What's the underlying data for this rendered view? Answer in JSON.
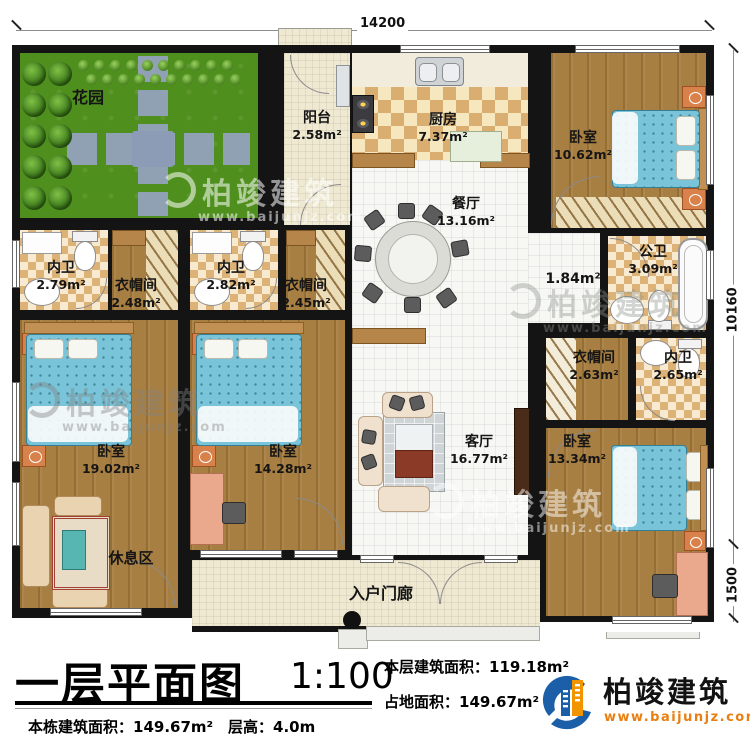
{
  "plan": {
    "title": "一层平面图",
    "scale": "1:100"
  },
  "dimensions": {
    "top": "14200",
    "right_main": "10160",
    "right_lower": "1500"
  },
  "rooms": {
    "garden": {
      "name": "花园"
    },
    "balcony": {
      "name": "阳台",
      "area": "2.58m²"
    },
    "kitchen": {
      "name": "厨房",
      "area": "7.37m²"
    },
    "dining": {
      "name": "餐厅",
      "area": "13.16m²"
    },
    "bedroom_top_right": {
      "name": "卧室",
      "area": "10.62m²"
    },
    "bath_1": {
      "name": "内卫",
      "area": "2.79m²"
    },
    "closet_1": {
      "name": "衣帽间",
      "area": "2.48m²"
    },
    "bath_2": {
      "name": "内卫",
      "area": "2.82m²"
    },
    "closet_2": {
      "name": "衣帽间",
      "area": "2.45m²"
    },
    "public_bath": {
      "name": "公卫",
      "area": "3.09m²"
    },
    "hallway": {
      "area": "1.84m²"
    },
    "closet_3": {
      "name": "衣帽间",
      "area": "2.63m²"
    },
    "bath_3": {
      "name": "内卫",
      "area": "2.65m²"
    },
    "bedroom_left": {
      "name": "卧室",
      "area": "19.02m²"
    },
    "bedroom_mid": {
      "name": "卧室",
      "area": "14.28m²"
    },
    "living": {
      "name": "客厅",
      "area": "16.77m²"
    },
    "bedroom_bottom_right": {
      "name": "卧室",
      "area": "13.34m²"
    },
    "lounge": {
      "name": "休息区"
    },
    "entry_porch": {
      "name": "入户门廊"
    }
  },
  "title_block": {
    "floor_area_label": "本层建筑面积：",
    "floor_area_value": "119.18m²",
    "land_area_label": "占地面积：",
    "land_area_value": "149.67m²",
    "building_area_label": "本栋建筑面积：",
    "building_area_value": "149.67m²",
    "floor_height_label": "层高：",
    "floor_height_value": "4.0m"
  },
  "logo": {
    "name": "柏竣建筑",
    "site": "www.baijunjz.com",
    "blue": "#1b5fa8",
    "orange": "#f29400"
  },
  "watermark": {
    "brand": "柏竣建筑",
    "site": "www.baijunjz.com"
  }
}
